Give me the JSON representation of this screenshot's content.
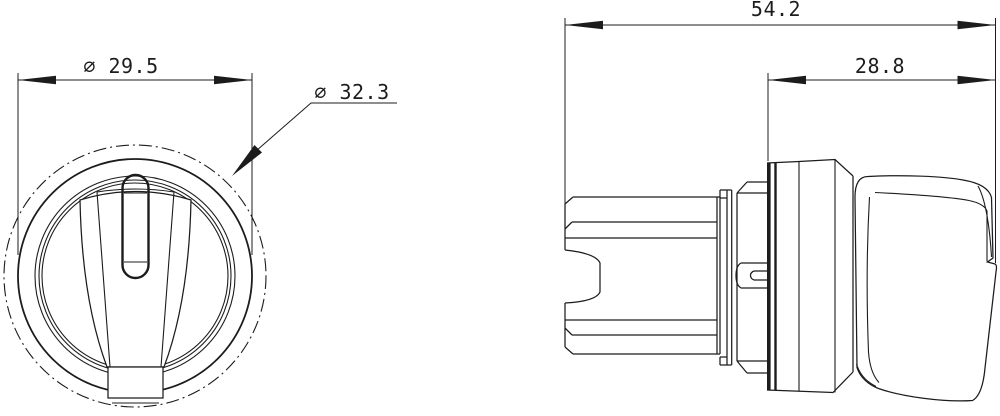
{
  "drawing": {
    "type": "technical-dimension-drawing",
    "subject": "selector switch actuator, front and side views",
    "colors": {
      "line": "#1c1c1c",
      "background": "#ffffff"
    },
    "dimensions": {
      "knob_diameter": {
        "label": "⌀ 29.5"
      },
      "bezel_diameter": {
        "label": "⌀ 32.3"
      },
      "overall_depth": {
        "label": "54.2"
      },
      "front_depth": {
        "label": "28.8"
      }
    }
  }
}
